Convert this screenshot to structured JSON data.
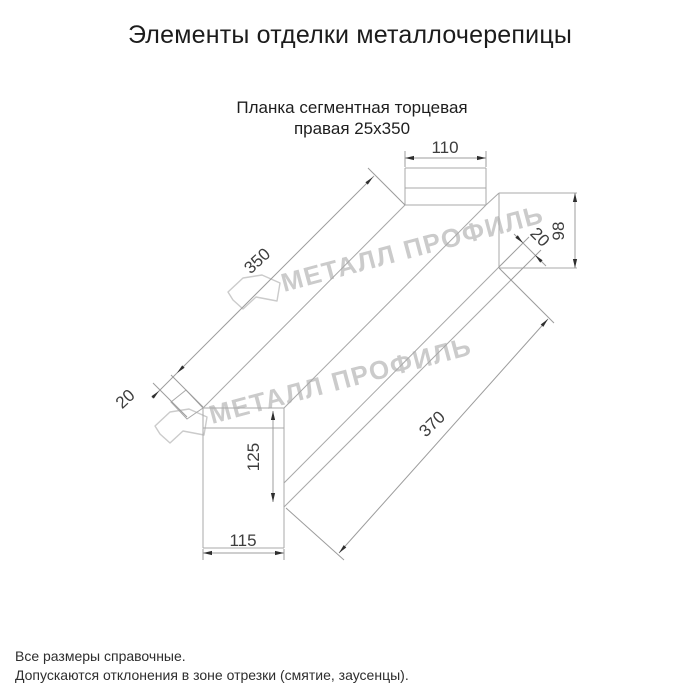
{
  "header": {
    "title": "Элементы отделки металлочерепицы",
    "subtitle_line1": "Планка сегментная торцевая",
    "subtitle_line2": "правая 25х350"
  },
  "drawing": {
    "line_color": "#a8a8a8",
    "dim_line_color": "#9c9c9c",
    "dim_text_color": "#3d3d3d",
    "arrow_color": "#2f2f2f",
    "dims": {
      "flange_width": "110",
      "right_end_height": "98",
      "right_bend": "20",
      "top_edge_length": "350",
      "left_bend": "20",
      "bottom_edge_length": "370",
      "left_end_height": "125",
      "left_end_width": "115"
    }
  },
  "watermark": {
    "text": "МЕТАЛЛ ПРОФИЛЬ",
    "color": "#cbcbcb"
  },
  "footer": {
    "note1": "Все размеры справочные.",
    "note2": "Допускаются отклонения в зоне отрезки (смятие, заусенцы)."
  }
}
